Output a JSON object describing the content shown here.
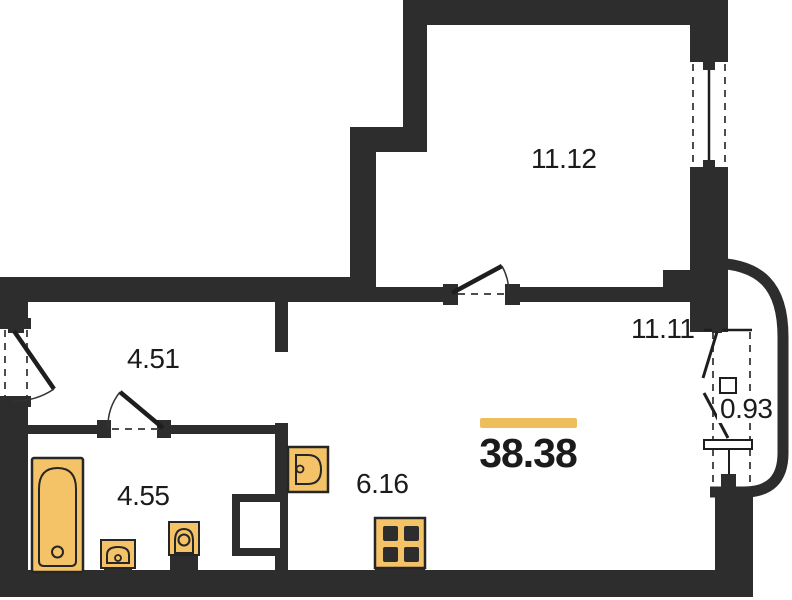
{
  "plan": {
    "total_area": "38.38",
    "rooms": [
      {
        "id": "bedroom",
        "area": "11.12"
      },
      {
        "id": "hallway",
        "area": "4.51"
      },
      {
        "id": "bathroom",
        "area": "4.55"
      },
      {
        "id": "kitchen",
        "area": "6.16"
      },
      {
        "id": "living-room",
        "area": "11.11"
      },
      {
        "id": "balcony",
        "area": "0.93"
      }
    ],
    "fixtures": [
      "bathtub-icon",
      "washbasin-icon",
      "toilet-icon",
      "kitchen-sink-icon",
      "stove-icon",
      "duct-shaft",
      "window-icon",
      "entrance-door-icon",
      "bathroom-door-icon",
      "bedroom-door-icon",
      "balcony-door-icon"
    ]
  },
  "colors": {
    "wall": "#2d2d2d",
    "fixture-fill": "#F4C368",
    "fixture-stroke": "#262626",
    "accent": "#EFBE5C",
    "text": "#1b1b1b",
    "dash": "#4d4d4d"
  }
}
